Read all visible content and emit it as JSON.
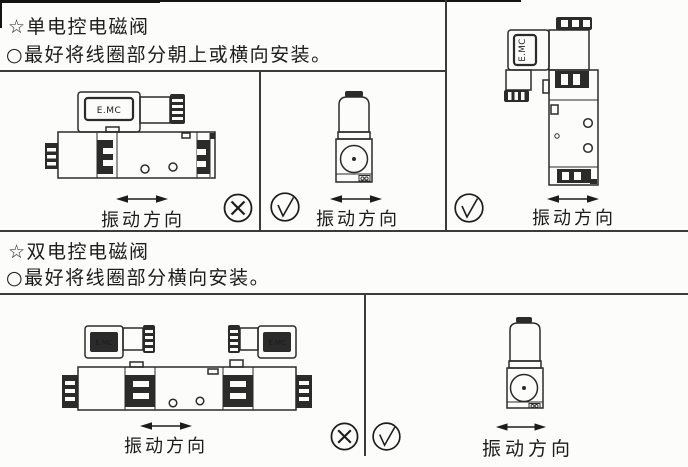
{
  "brand_label": "E.MC",
  "sections": {
    "single": {
      "title": "☆单电控电磁阀",
      "note": "○最好将线圈部分朝上或横向安装。",
      "panels": [
        {
          "name": "horizontal-mount",
          "vibration_label": "振动方向",
          "verdict": "wrong"
        },
        {
          "name": "vertical-mount",
          "vibration_label": "振动方向",
          "verdict": "correct"
        },
        {
          "name": "side-mount",
          "vibration_label": "振动方向",
          "verdict": "correct"
        }
      ]
    },
    "double": {
      "title": "☆双电控电磁阀",
      "note": "○最好将线圈部分横向安装。",
      "panels": [
        {
          "name": "horizontal-mount",
          "vibration_label": "振动方向",
          "verdict": "wrong"
        },
        {
          "name": "vertical-mount",
          "vibration_label": "振动方向",
          "verdict": "correct"
        }
      ]
    }
  },
  "colors": {
    "line": "#2b2b2b",
    "background": "#fcfcfb"
  }
}
